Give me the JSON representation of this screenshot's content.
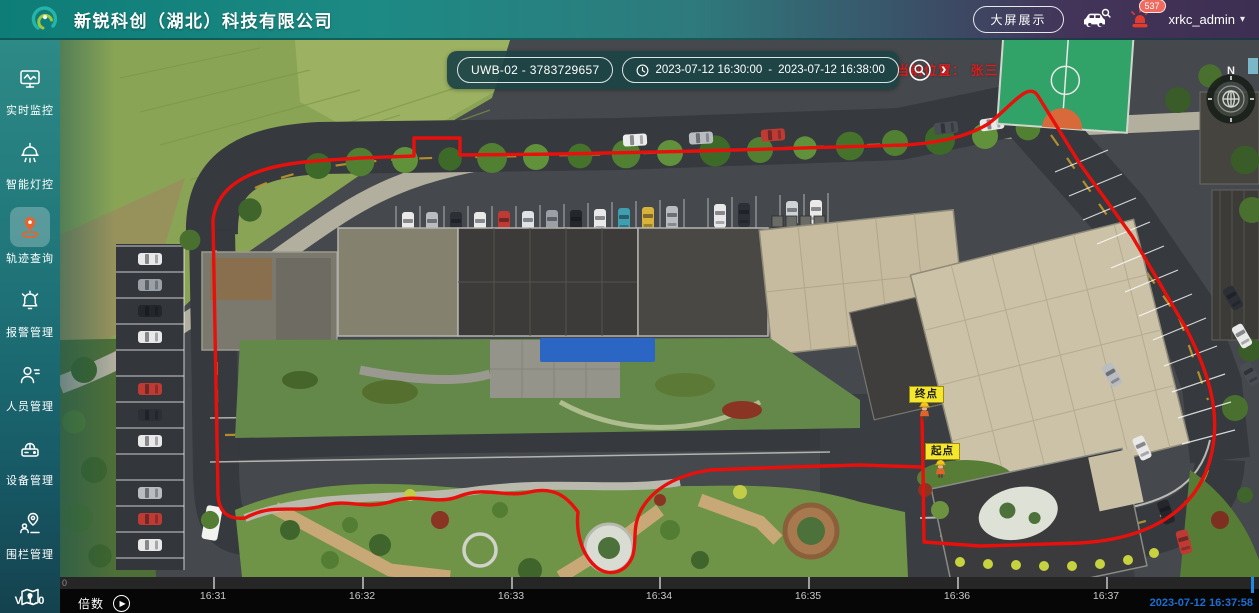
{
  "header": {
    "title": "新锐科创（湖北）科技有限公司",
    "big_screen_button": "大屏展示",
    "alarm_badge": "537",
    "username": "xrkc_admin",
    "caret": "▾"
  },
  "sidebar": {
    "items": [
      {
        "label": "实时监控",
        "icon": "monitor-icon",
        "active": false
      },
      {
        "label": "智能灯控",
        "icon": "light-icon",
        "active": false
      },
      {
        "label": "轨迹查询",
        "icon": "track-icon",
        "active": true
      },
      {
        "label": "报警管理",
        "icon": "alarm-bell-icon",
        "active": false
      },
      {
        "label": "人员管理",
        "icon": "person-icon",
        "active": false
      },
      {
        "label": "设备管理",
        "icon": "device-icon",
        "active": false
      },
      {
        "label": "围栏管理",
        "icon": "fence-icon",
        "active": false
      },
      {
        "label": "",
        "icon": "map-icon",
        "active": false
      }
    ],
    "version": "V 1.0"
  },
  "search_bar": {
    "device": "UWB-02 - 3783729657",
    "start_time": "2023-07-12 16:30:00",
    "separator": "-",
    "end_time": "2023-07-12 16:38:00",
    "chevron": "›"
  },
  "map_overlay": {
    "current_location": "当前位置： 张三",
    "end_marker": "终点",
    "start_marker": "起点",
    "compass_n": "N"
  },
  "timeline": {
    "speed_label": "倍数",
    "play_icon": "▶",
    "zero_label": "0",
    "ticks": [
      {
        "label": "16:31",
        "x": 153
      },
      {
        "label": "16:32",
        "x": 302
      },
      {
        "label": "16:33",
        "x": 451
      },
      {
        "label": "16:34",
        "x": 599
      },
      {
        "label": "16:35",
        "x": 748
      },
      {
        "label": "16:36",
        "x": 897
      },
      {
        "label": "16:37",
        "x": 1046
      }
    ],
    "playhead_x": 1191,
    "current_time": "2023-07-12 16:37:58"
  },
  "colors": {
    "header_teal": "#1d8a84",
    "header_purple": "#3d2f52",
    "trajectory_red": "#e8100c",
    "marker_yellow": "#f5e62e",
    "playhead_blue": "#1e88e5",
    "active_icon_orange": "#e8632c",
    "alarm_red": "#e23b30"
  }
}
